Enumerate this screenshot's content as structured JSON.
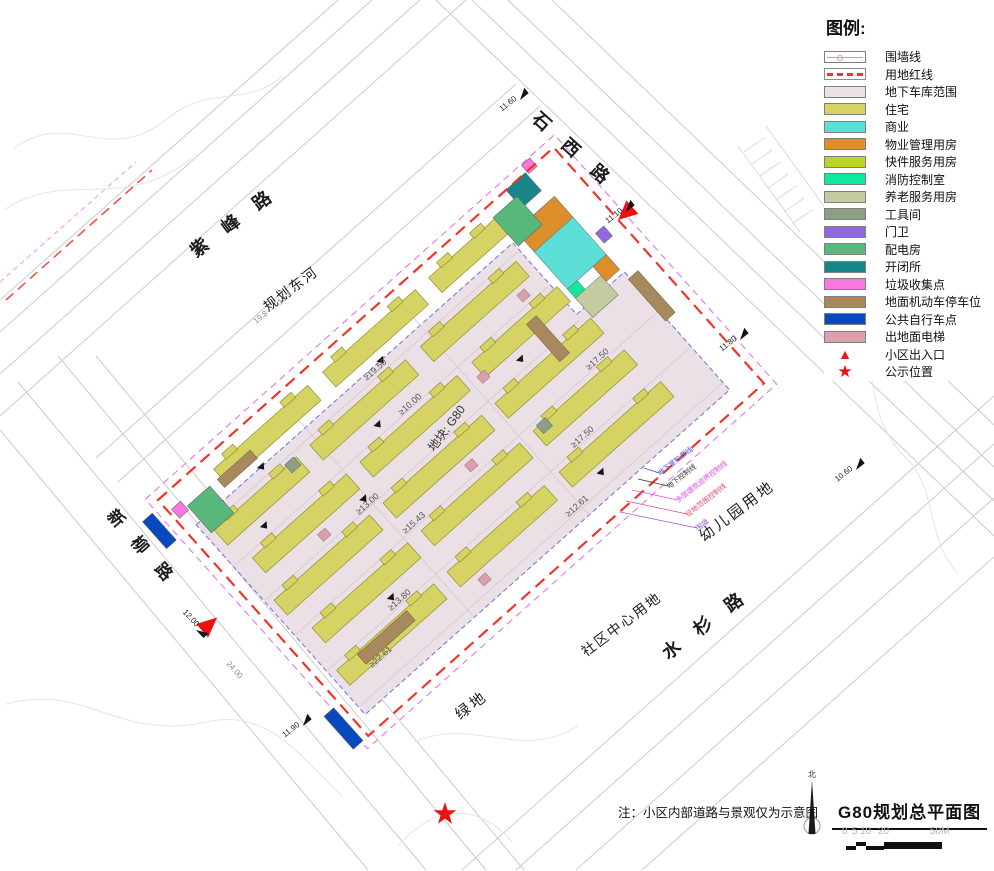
{
  "legend": {
    "title": "图例:",
    "items": [
      {
        "label": "围墙线",
        "type": "wall"
      },
      {
        "label": "用地红线",
        "type": "redline",
        "color": "#f0342c"
      },
      {
        "label": "地下车库范围",
        "color": "#ebe0e5"
      },
      {
        "label": "住宅",
        "color": "#d6d365"
      },
      {
        "label": "商业",
        "color": "#5cdfd6"
      },
      {
        "label": "物业管理用房",
        "color": "#dd8d2a"
      },
      {
        "label": "快件服务用房",
        "color": "#bcd42a"
      },
      {
        "label": "消防控制室",
        "color": "#10e89e"
      },
      {
        "label": "养老服务用房",
        "color": "#c6caa0"
      },
      {
        "label": "工具间",
        "color": "#8c9e84"
      },
      {
        "label": "门卫",
        "color": "#9268e0"
      },
      {
        "label": "配电房",
        "color": "#58b87c"
      },
      {
        "label": "开闭所",
        "color": "#17858a"
      },
      {
        "label": "垃圾收集点",
        "color": "#f878e0"
      },
      {
        "label": "地面机动车停车位",
        "color": "#a8895e"
      },
      {
        "label": "公共自行车点",
        "color": "#0a48c0"
      },
      {
        "label": "出地面电梯",
        "color": "#d8a2ac"
      },
      {
        "label": "小区出入口",
        "type": "triangle",
        "color": "#ee1111"
      },
      {
        "label": "公示位置",
        "type": "star",
        "color": "#ee1111"
      }
    ]
  },
  "roads": {
    "zifeng_road": "紫 峰 路",
    "planned_east_river": "规划东河",
    "shixi_road": "石 西 路",
    "xinliu_road": "新 柳 路",
    "shuishan_road": "水 杉 路"
  },
  "adjacent": {
    "green_space": "绿地",
    "community_center": "社区中心用地",
    "kindergarten": "幼儿园用地"
  },
  "site": {
    "block_label": "地块: G80",
    "setbacks": [
      "≥19.50",
      "≥10.00",
      "≥13.00",
      "≥15.43",
      "≥17.50",
      "≥13.80",
      "≥22.61",
      "≥12.61"
    ],
    "dims": [
      "19.8",
      "10.3",
      "24.00"
    ]
  },
  "boundary_notes": [
    {
      "text": "地下室轮廓线",
      "color": "#4848d8"
    },
    {
      "text": "地下控制线",
      "color": "#333333"
    },
    {
      "text": "多层建筑退界控制线",
      "color": "#e648e6"
    },
    {
      "text": "征地范围控制线",
      "color": "#e64878"
    },
    {
      "text": "围墙",
      "color": "#9a55cc"
    }
  ],
  "elevation_markers": [
    {
      "value": "11.60"
    },
    {
      "value": "11.10"
    },
    {
      "value": "11.80"
    },
    {
      "value": "10.60"
    },
    {
      "value": "11.90"
    },
    {
      "value": "12.00"
    }
  ],
  "note": "注：小区内部道路与景观仅为示意图",
  "titleblock": {
    "north_label": "北",
    "title": "G80规划总平面图",
    "scale_ticks": [
      "0",
      "5",
      "10",
      "20",
      "50M"
    ]
  },
  "colors": {
    "red_line": "#f0342c",
    "setback_line": "#ee55ee",
    "residential": "#d6d365",
    "garage": "#ebe0e5",
    "garage_outline": "#7a7ae0",
    "commercial": "#5cdfd6",
    "property_mgmt": "#dd8d2a",
    "express": "#bcd42a",
    "fire_control": "#10e89e",
    "elderly": "#c6caa0",
    "tool_room": "#8c9e84",
    "gate_guard": "#9268e0",
    "power_room": "#58b87c",
    "switch_station": "#17858a",
    "garbage": "#f878e0",
    "parking": "#a8895e",
    "bicycle": "#0a48c0",
    "elevator": "#d8a2ac",
    "entrance_marker": "#ee1111",
    "road_line": "#cbcbcb"
  }
}
